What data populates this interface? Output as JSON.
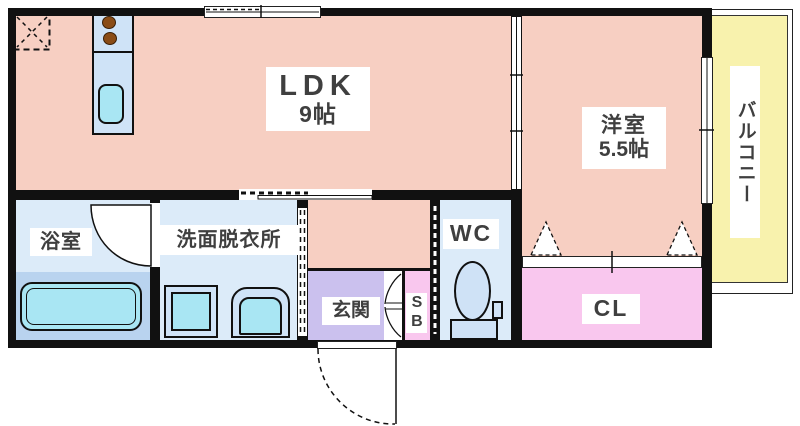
{
  "title": "apartment-floor-plan",
  "colors": {
    "wall": "#111111",
    "outline": "#111111",
    "room_salmon": "#f7cfc2",
    "room_light_blue": "#dcebf9",
    "bath_lower_blue": "#b9d3ef",
    "fixture_blue": "#cfe3f7",
    "fixture_cyan": "#a9e6f3",
    "entrance_purple": "#cbc1ee",
    "closet_pink": "#f9c7ee",
    "balcony_yellow": "#f8f2ad",
    "toilet_blue": "#cfe2f6",
    "burner_brown": "#8a4c16",
    "label_text": "#3f3f3f"
  },
  "rooms": {
    "ldk": {
      "name": "LDK",
      "size": "9帖"
    },
    "western_room": {
      "name": "洋室",
      "size": "5.5帖"
    },
    "balcony": {
      "name": "バルコニー"
    },
    "bathroom": {
      "name": "浴室"
    },
    "washroom": {
      "name": "洗面脱衣所"
    },
    "entrance": {
      "name": "玄関"
    },
    "shoe_box": {
      "name": "SB"
    },
    "toilet_room": {
      "name": "WC"
    },
    "closet": {
      "name": "CL"
    }
  }
}
